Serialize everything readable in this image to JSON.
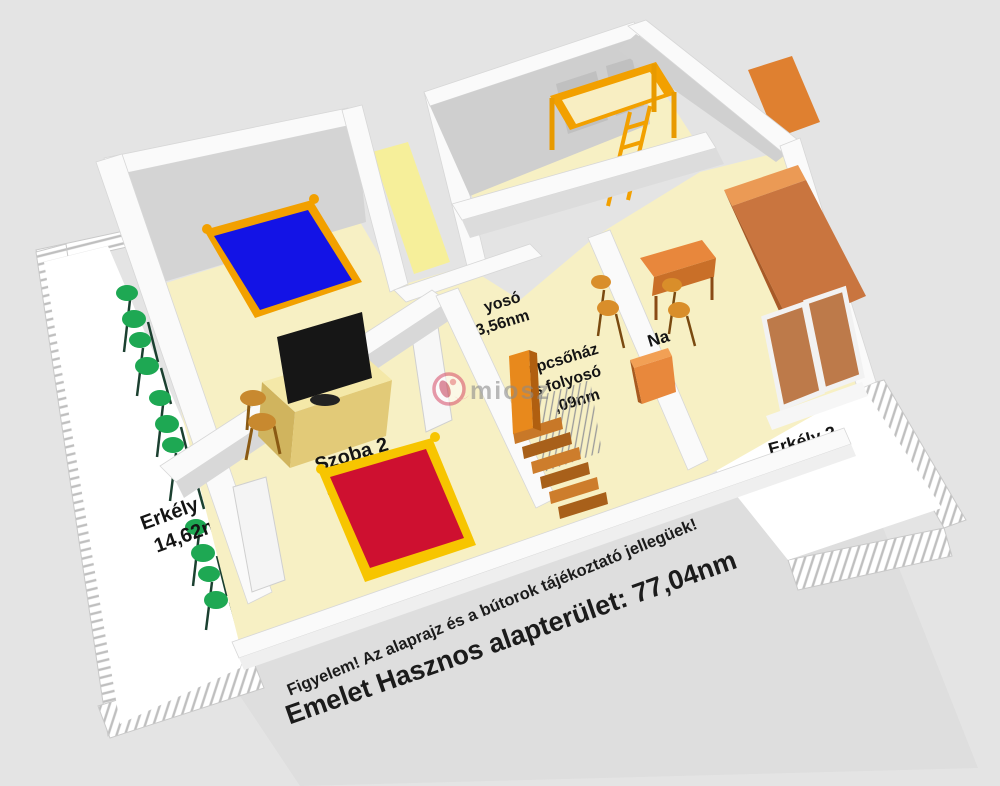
{
  "colors": {
    "background": "#e4e4e4",
    "wall_white": "#fafafa",
    "wall_gray": "#d2d2d2",
    "floor_cream": "#f7f0c4",
    "floor_yellow": "#f6ef9a",
    "balcony_white": "#ffffff",
    "bed_blue": "#1313e6",
    "bed_red": "#ce1030",
    "frame_orange": "#f2a000",
    "frame_yellow": "#f7c500",
    "furniture_orange": "#e8873c",
    "wardrobe_orange": "#c9753f",
    "cabinet_tan": "#e2ca78",
    "tv_black": "#161616",
    "chair_green": "#1ea853",
    "chair_wood": "#c8892f",
    "stairs_orange": "#c87828",
    "watermark_pink": "#d95570",
    "watermark_gray": "#8a8a8a"
  },
  "rooms": {
    "balcony1": {
      "name": "Erkély 1",
      "area": "14,62nm"
    },
    "room2": {
      "name": "Szoba 2",
      "area": "15,79nm"
    },
    "corridor": {
      "name_fragment": "yosó",
      "area": "3,56nm"
    },
    "stairwell": {
      "name_line1": "Lépcsőház",
      "name_line2": "és folyosó",
      "area_fragment": ",09nm"
    },
    "living_room": {
      "name_fragment": "Na"
    },
    "balcony2": {
      "name": "Erkély 2",
      "area": "8,44nm"
    }
  },
  "watermark": {
    "text": "miosz"
  },
  "footer": {
    "disclaimer": "Figyelem! Az alaprajz és a bútorok tájékoztató jellegüek!",
    "total": "Emelet Hasznos alapterület: 77,04nm"
  }
}
